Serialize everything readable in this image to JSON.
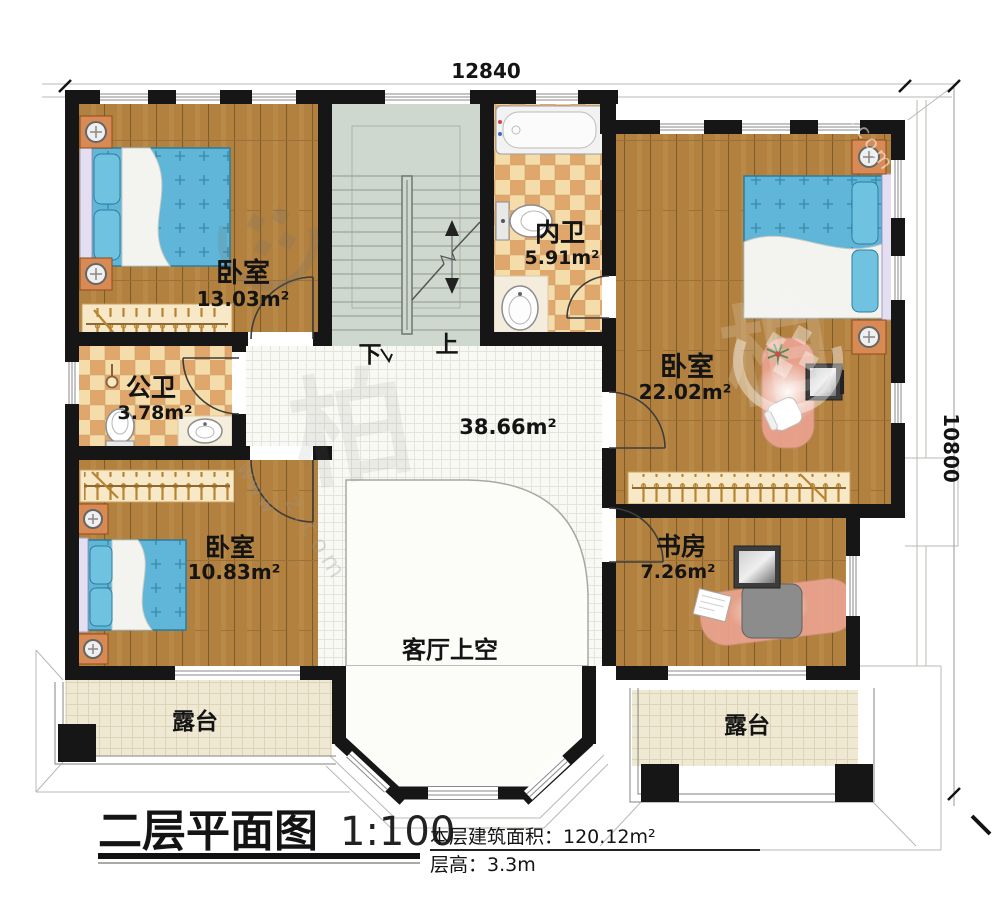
{
  "title_block": {
    "title": "二层平面图",
    "scale": "1:100",
    "area_line": "本层建筑面积：120.12m²",
    "height_line": "层高：3.3m"
  },
  "dimensions": {
    "top": "12840",
    "right": "10800"
  },
  "rooms": [
    {
      "name": "卧室",
      "area": "13.03m²"
    },
    {
      "name": "内卫",
      "area": "5.91m²"
    },
    {
      "name": "卧室",
      "area": "22.02m²"
    },
    {
      "name": "公卫",
      "area": "3.78m²"
    },
    {
      "name": "卧室",
      "area": "10.83m²"
    },
    {
      "name": "书房",
      "area": "7.26m²"
    }
  ],
  "labels": {
    "hall_area": "38.66m²",
    "living_void": "客厅上空",
    "terrace_left": "露台",
    "terrace_right": "露台"
  },
  "stairs": {
    "down": "下",
    "up": "上"
  },
  "watermark": {
    "char": "柏",
    "www": "www",
    "url_fragment": "z.com"
  },
  "colors": {
    "wall": "#161616",
    "wood": "#b28140",
    "tile_light": "#f4dcab",
    "tile_dark": "#dfa76c",
    "bed": "#5fb6d8",
    "stairs": "#cfd8ce",
    "hall_tile": "#f8f8f5",
    "terrace": "#efe9d3",
    "desk": "#eba390"
  }
}
